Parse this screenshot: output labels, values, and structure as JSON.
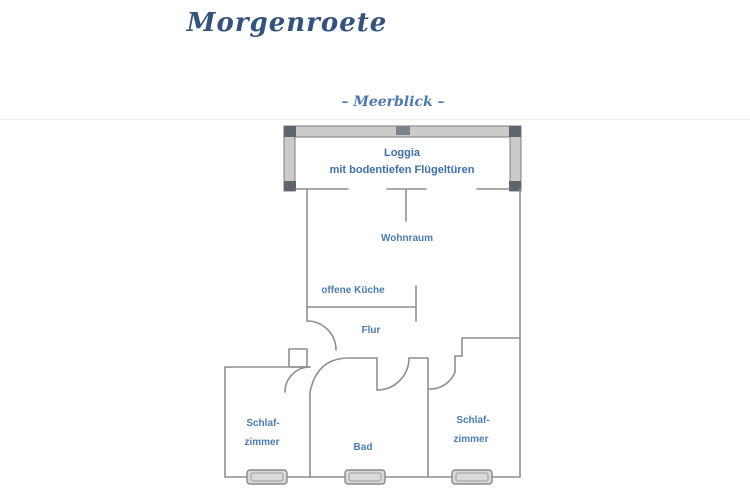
{
  "title": "Morgenroete",
  "subtitle": "– Meerblick –",
  "labels": {
    "loggia_line1": "Loggia",
    "loggia_line2": "mit bodentiefen Flügeltüren",
    "wohnraum": "Wohnraum",
    "kueche": "offene Küche",
    "flur": "Flur",
    "bad": "Bad",
    "schlaf_left_line1": "Schlaf-",
    "schlaf_left_line2": "zimmer",
    "schlaf_right_line1": "Schlaf-",
    "schlaf_right_line2": "zimmer"
  },
  "colors": {
    "background": "#ffffff",
    "title_text": "#33527d",
    "subtitle_text": "#4d79b0",
    "room_label_text": "#4a7cb8",
    "wall_line": "#8f8f8f",
    "loggia_wall_fill": "#cbcbcb",
    "loggia_wall_caps": "#60656b",
    "window_fill": "#d9d9d9"
  }
}
